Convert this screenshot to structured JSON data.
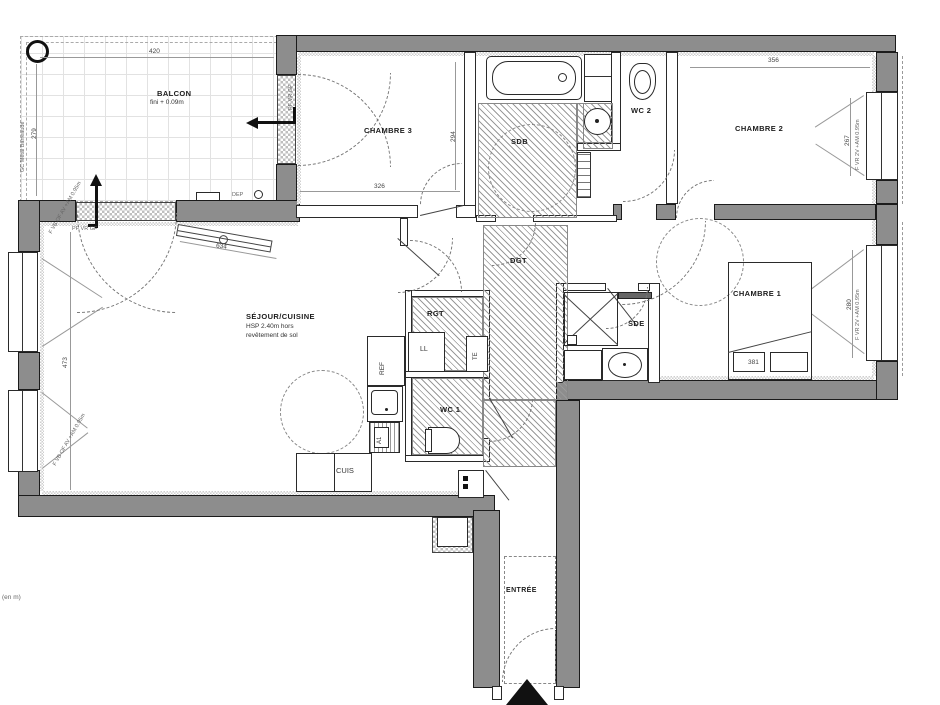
{
  "unit_note": "(en m)",
  "colors": {
    "wall": "#8d8d8d",
    "line": "#1b1b1b",
    "hatch": "#9a9a9a",
    "dim_text": "#444"
  },
  "rooms": {
    "balcon": {
      "label": "BALCON",
      "note": "fini + 0.09m"
    },
    "chambre3": {
      "label": "CHAMBRE 3"
    },
    "sdb": {
      "label": "SDB"
    },
    "wc2": {
      "label": "WC 2"
    },
    "chambre2": {
      "label": "CHAMBRE 2"
    },
    "chambre1": {
      "label": "CHAMBRE 1"
    },
    "sde": {
      "label": "SDE"
    },
    "dgt": {
      "label": "DGT"
    },
    "rgt": {
      "label": "RGT"
    },
    "wc1": {
      "label": "WC 1"
    },
    "sejour": {
      "label": "SÉJOUR/CUISINE",
      "note_line1": "HSP 2.40m hors",
      "note_line2": "revêtement de sol"
    },
    "entree": {
      "label": "ENTRÉE"
    }
  },
  "fixtures": {
    "ll": "LL",
    "te": "TE",
    "ref": "REF",
    "a1": "A1",
    "cuis": "CUIS",
    "dep": "DEP"
  },
  "dimensions": {
    "balcon_w": "420",
    "balcon_h": "279",
    "ch3_w": "326",
    "ch3_h": "294",
    "ch2_w": "356",
    "ch2_win": "267",
    "sejour_h": "473",
    "sejour_diag": "634",
    "ch1_bed": "381",
    "ch1_win": "280"
  },
  "window_labels": {
    "balcon_rail": "GC Métal Barreaudé",
    "ch3_door": "PF VR GF",
    "sejour_door": "PF VR GF",
    "sejour_win1": "F VB OF AV +AM 0.95m",
    "sejour_win2": "F VB OF AV +AM 0.95m",
    "ch2_win": "F VR 2V +AM 0.95m",
    "ch1_win": "F VR 2V +AM 0.95m"
  }
}
